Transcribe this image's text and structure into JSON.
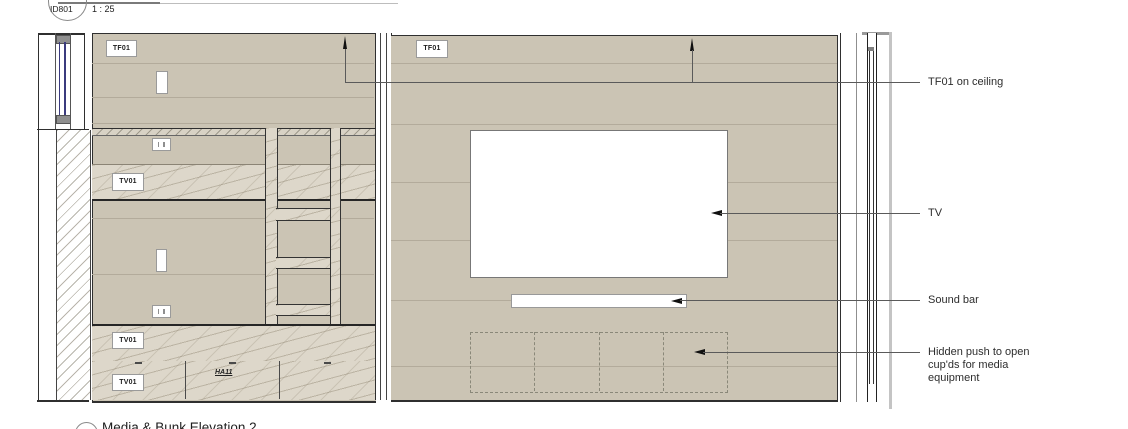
{
  "reference": {
    "id": "ID801",
    "scale": "1 : 25"
  },
  "tags": {
    "tf01": "TF01",
    "tv01": "TV01",
    "ha11": "HA11"
  },
  "annotations": {
    "ceiling": "TF01 on ceiling",
    "tv": "TV",
    "soundbar": "Sound bar",
    "cupboards_line1": "Hidden push to open",
    "cupboards_line2": "cup'ds for media",
    "cupboards_line3": "equipment"
  },
  "title": {
    "number": "2",
    "text": "Media & Bunk Elevation 2"
  },
  "colors": {
    "wall": "#cbc4b4",
    "wood": "#ddd7ca",
    "outline": "#2f2f2f",
    "leader": "#5a5a5a",
    "glazing": "#3b3b7e"
  }
}
